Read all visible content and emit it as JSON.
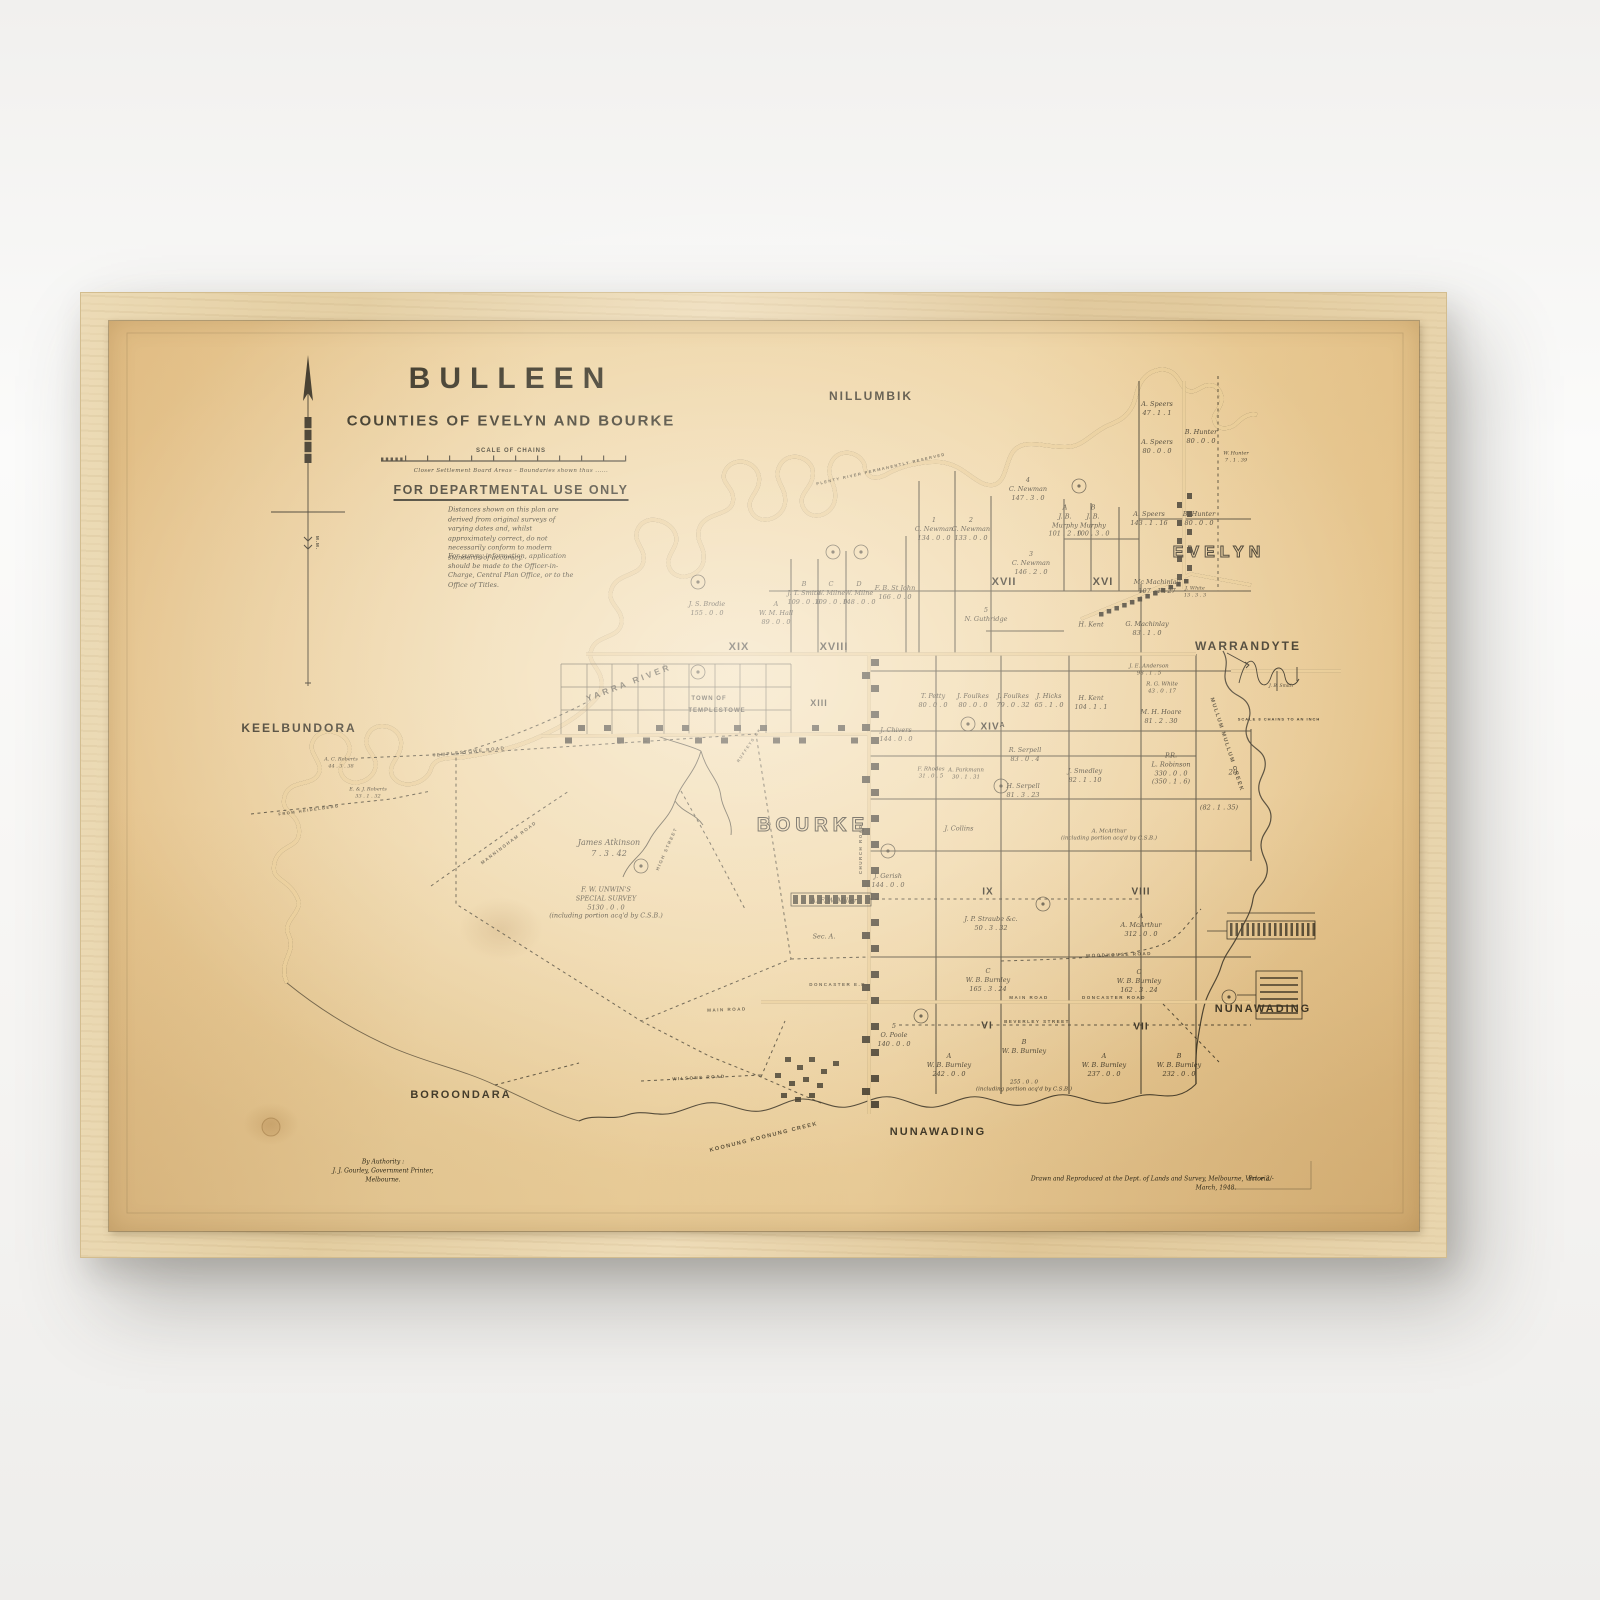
{
  "artwork": {
    "type": "framed vintage cadastral map",
    "frame_wood_color": "#e6d2a8",
    "paper_color": "#e9cb93",
    "ink_color": "#3a3222"
  },
  "map": {
    "header": {
      "title": "BULLEEN",
      "subtitle": "COUNTIES OF EVELYN AND BOURKE",
      "scale_heading": "SCALE OF CHAINS",
      "scale_note": "Closer Settlement Board Areas – Boundaries shown thus ......",
      "departmental": "FOR DEPARTMENTAL USE ONLY",
      "disclaimer_1": "Distances shown on this plan are derived from original surveys of varying dates and, whilst approximately correct, do not necessarily conform to modern standards of accuracy.",
      "disclaimer_2": "For survey information, application should be made to the Officer-in-Charge, Central Plan Office, or to the Office of Titles."
    },
    "north_arrow_label": "M.M.",
    "outline_regions": [
      {
        "t": "BOURKE",
        "x": 704,
        "y": 510,
        "fs": 19,
        "ls": 5
      },
      {
        "t": "EVELYN",
        "x": 1110,
        "y": 236,
        "fs": 16,
        "ls": 5
      }
    ],
    "regions": [
      {
        "t": "NILLUMBIK",
        "x": 762,
        "y": 76,
        "s": 12
      },
      {
        "t": "WARRANDYTE",
        "x": 1139,
        "y": 326,
        "s": 12
      },
      {
        "t": "KEELBUNDORA",
        "x": 190,
        "y": 408,
        "s": 12
      },
      {
        "t": "BOROONDARA",
        "x": 352,
        "y": 774,
        "s": 11
      },
      {
        "t": "NUNAWADING",
        "x": 1154,
        "y": 688,
        "s": 11
      },
      {
        "t": "NUNAWADING",
        "x": 829,
        "y": 811,
        "s": 11
      }
    ],
    "sections": [
      {
        "t": "XIX",
        "x": 630,
        "y": 326,
        "s": 11
      },
      {
        "t": "XVIII",
        "x": 725,
        "y": 326,
        "s": 11
      },
      {
        "t": "XIII",
        "x": 710,
        "y": 383,
        "s": 9
      },
      {
        "t": "XVII",
        "x": 895,
        "y": 261,
        "s": 11
      },
      {
        "t": "XVI",
        "x": 994,
        "y": 261,
        "s": 11
      },
      {
        "t": "XIVᴬ",
        "x": 884,
        "y": 406,
        "s": 10
      },
      {
        "t": "IX",
        "x": 879,
        "y": 571,
        "s": 10
      },
      {
        "t": "VIII",
        "x": 1032,
        "y": 571,
        "s": 10
      },
      {
        "t": "VI",
        "x": 878,
        "y": 705,
        "s": 10
      },
      {
        "t": "VII",
        "x": 1032,
        "y": 706,
        "s": 10
      }
    ],
    "micro_labels": [
      {
        "t": "TOWN OF",
        "x": 600,
        "y": 379,
        "s": 6
      },
      {
        "t": "TEMPLESTOWE",
        "x": 608,
        "y": 391,
        "s": 6
      },
      {
        "t": "SCALE 8 CHAINS TO AN INCH",
        "x": 1170,
        "y": 398,
        "s": 4
      },
      {
        "t": "M.M.",
        "x": 208,
        "y": 222,
        "s": 4.5,
        "r": 90
      }
    ],
    "parcels": [
      {
        "t": "J. S. Brodie\n155 . 0 . 0",
        "x": 598,
        "y": 288
      },
      {
        "t": "A\nW. M. Hall\n89 . 0 . 0",
        "x": 667,
        "y": 292
      },
      {
        "t": "B\nJ. T. Smith\n109 . 0 . 0",
        "x": 695,
        "y": 272
      },
      {
        "t": "C\nW. Milne\n109 . 0 . 0",
        "x": 722,
        "y": 272
      },
      {
        "t": "D\nW. Milne\n148 . 0 . 0",
        "x": 750,
        "y": 272
      },
      {
        "t": "F. B. St John\n166 . 0 . 0",
        "x": 786,
        "y": 272
      },
      {
        "t": "1\nC. Newman\n134 . 0 . 0",
        "x": 825,
        "y": 208
      },
      {
        "t": "2\nC. Newman\n133 . 0 . 0",
        "x": 862,
        "y": 208
      },
      {
        "t": "4\nC. Newman\n147 . 3 . 0",
        "x": 919,
        "y": 168
      },
      {
        "t": "3\nC. Newman\n146 . 2 . 0",
        "x": 922,
        "y": 242
      },
      {
        "t": "A\nJ. B.\nMurphy\n101 . 2 . 0",
        "x": 956,
        "y": 200
      },
      {
        "t": "B\nJ. B.\nMurphy\n100 . 3 . 0",
        "x": 984,
        "y": 200
      },
      {
        "t": "A. Speers\n47 . 1 . 1",
        "x": 1048,
        "y": 88
      },
      {
        "t": "A. Speers\n80 . 0 . 0",
        "x": 1048,
        "y": 126
      },
      {
        "t": "B. Hunter\n80 . 0 . 0",
        "x": 1092,
        "y": 116
      },
      {
        "t": "W. Hunter\n7 . 1 . 39",
        "x": 1127,
        "y": 136,
        "s": 5
      },
      {
        "t": "A. Speers\n143 . 1 . 16",
        "x": 1040,
        "y": 198
      },
      {
        "t": "B. Hunter\n80 . 0 . 0",
        "x": 1090,
        "y": 198
      },
      {
        "t": "Mc Machinlay\n107 . 1 . 27",
        "x": 1048,
        "y": 266
      },
      {
        "t": "J. White\n13 . 3 . 3",
        "x": 1086,
        "y": 271,
        "s": 5
      },
      {
        "t": "G. Machinlay\n83 . 1 . 0",
        "x": 1038,
        "y": 308
      },
      {
        "t": "H. Kent",
        "x": 982,
        "y": 304
      },
      {
        "t": "5\nN. Guthridge",
        "x": 877,
        "y": 294
      },
      {
        "t": "J. E. Anderson\n98 . 1 . 5",
        "x": 1040,
        "y": 350,
        "s": 5.5
      },
      {
        "t": "R. G. White\n43 . 0 . 17",
        "x": 1053,
        "y": 368,
        "s": 5.5
      },
      {
        "t": "M. H. Hoare\n81 . 2 . 30",
        "x": 1052,
        "y": 396
      },
      {
        "t": "H. Kent\n104 . 1 . 1",
        "x": 982,
        "y": 382
      },
      {
        "t": "T. Petty\n80 . 0 . 0",
        "x": 824,
        "y": 380
      },
      {
        "t": "J. Foulkes\n80 . 0 . 0",
        "x": 864,
        "y": 380
      },
      {
        "t": "J. Foulkes\n79 . 0 . 32",
        "x": 904,
        "y": 380
      },
      {
        "t": "J. Hicks\n65 . 1 . 0",
        "x": 940,
        "y": 380
      },
      {
        "t": "J. Chivers\n144 . 0 . 0",
        "x": 787,
        "y": 414
      },
      {
        "t": "R. Serpell\n83 . 0 . 4",
        "x": 916,
        "y": 434
      },
      {
        "t": "F. Rhodes\n31 . 0 . 5",
        "x": 822,
        "y": 453,
        "s": 5.5
      },
      {
        "t": "A. Parkmann\n30 . 1 . 31",
        "x": 857,
        "y": 454,
        "s": 5.5
      },
      {
        "t": "H. Serpell\n81 . 3 . 23",
        "x": 914,
        "y": 470
      },
      {
        "t": "J. Smedley\n82 . 1 . 10",
        "x": 976,
        "y": 455
      },
      {
        "t": "P.R.\nL. Robinson\n330 . 0 . 0\n(350 . 1 . 6)",
        "x": 1062,
        "y": 448
      },
      {
        "t": "20",
        "x": 1124,
        "y": 452,
        "s": 7
      },
      {
        "t": "(82 . 1 . 35)",
        "x": 1110,
        "y": 487
      },
      {
        "t": "J. Collins",
        "x": 850,
        "y": 508
      },
      {
        "t": "J. Gerish\n144 . 0 . 0",
        "x": 779,
        "y": 560
      },
      {
        "t": "A. McArthur\n(including portion acq'd by C.S.B.)",
        "x": 1000,
        "y": 515,
        "s": 5.5
      },
      {
        "t": "A. F. W. Miller",
        "x": 725,
        "y": 580
      },
      {
        "t": "Sec. A.",
        "x": 715,
        "y": 616
      },
      {
        "t": "J. P. Straube &c.\n50 . 3 . 32",
        "x": 882,
        "y": 603
      },
      {
        "t": "A\nA. McArthur\n312 . 0 . 0",
        "x": 1032,
        "y": 604
      },
      {
        "t": "C\nW. B. Burnley\n165 . 3 . 24",
        "x": 879,
        "y": 659
      },
      {
        "t": "C\nW. B. Burnley\n162 . 3 . 24",
        "x": 1030,
        "y": 660
      },
      {
        "t": "5\nO. Poole\n140 . 0 . 0",
        "x": 785,
        "y": 714
      },
      {
        "t": "B\nW. B. Burnley",
        "x": 915,
        "y": 726
      },
      {
        "t": "A\nW. B. Burnley\n242 . 0 . 0",
        "x": 840,
        "y": 744
      },
      {
        "t": "255 . 0 . 0\n(including portion acq'd by C.S.B.)",
        "x": 915,
        "y": 766,
        "s": 5.5
      },
      {
        "t": "A\nW. B. Burnley\n237 . 0 . 0",
        "x": 995,
        "y": 744
      },
      {
        "t": "B\nW. B. Burnley\n232 . 0 . 0",
        "x": 1070,
        "y": 744
      },
      {
        "t": "James Atkinson\n7 . 3 . 42",
        "x": 500,
        "y": 528,
        "s": 8
      },
      {
        "t": "F. W. UNWIN'S\nSPECIAL SURVEY\n5130 . 0 . 0\n(including portion acq'd by C.S.B.)",
        "x": 497,
        "y": 582,
        "s": 6.5
      },
      {
        "t": "A. C. Roberts\n44 . 3 . 38",
        "x": 232,
        "y": 442,
        "s": 5
      },
      {
        "t": "E. & J. Roberts\n33 . 1 . 32",
        "x": 259,
        "y": 472,
        "s": 5
      },
      {
        "t": "J. B. Smith",
        "x": 1172,
        "y": 366,
        "s": 4.5
      }
    ],
    "roads": [
      {
        "t": "YARRA  RIVER",
        "x": 520,
        "y": 362,
        "r": -21,
        "s": 8.5,
        "ls": 3
      },
      {
        "t": "TEMPLESTOWE  ROAD",
        "x": 360,
        "y": 431,
        "r": -6,
        "s": 4.5
      },
      {
        "t": "MANNINGHAM  ROAD",
        "x": 400,
        "y": 522,
        "r": -37,
        "s": 4.5
      },
      {
        "t": "FROM  HEIDELBERG",
        "x": 200,
        "y": 489,
        "r": -8,
        "s": 4
      },
      {
        "t": "HIGH  STREET",
        "x": 558,
        "y": 528,
        "r": -66,
        "s": 4.5
      },
      {
        "t": "CHURCH  ROAD",
        "x": 752,
        "y": 528,
        "r": -90,
        "s": 4.5
      },
      {
        "t": "RUFFEYS  CK",
        "x": 640,
        "y": 424,
        "r": -56,
        "s": 4
      },
      {
        "t": "DONCASTER  E.R.",
        "x": 730,
        "y": 664,
        "r": 0,
        "s": 4.5
      },
      {
        "t": "MAIN  ROAD",
        "x": 618,
        "y": 689,
        "r": -2,
        "s": 4.5
      },
      {
        "t": "MAIN  ROAD",
        "x": 920,
        "y": 677,
        "r": 0,
        "s": 4.5
      },
      {
        "t": "DONCASTER  ROAD",
        "x": 1005,
        "y": 677,
        "r": 0,
        "s": 4.5
      },
      {
        "t": "WOODHOUSE  ROAD",
        "x": 1010,
        "y": 634,
        "r": -2,
        "s": 4.5
      },
      {
        "t": "BEVERLEY  STREET",
        "x": 928,
        "y": 701,
        "r": 0,
        "s": 4.5
      },
      {
        "t": "WILSONS  ROAD",
        "x": 590,
        "y": 757,
        "r": -3,
        "s": 4.5
      },
      {
        "t": "KOONUNG  KOONUNG  CREEK",
        "x": 655,
        "y": 817,
        "r": -14,
        "s": 5.5
      },
      {
        "t": "MULLUM  MULLUM  CREEK",
        "x": 1117,
        "y": 424,
        "r": 72,
        "s": 5.5
      },
      {
        "t": "PLENTY  RIVER  PERMANENTLY  RESERVED",
        "x": 772,
        "y": 148,
        "r": -13,
        "s": 4
      }
    ],
    "credits": {
      "authority": "By Authority :\nJ. J. Gourley, Government Printer,\nMelbourne.",
      "drawn": "Drawn and Reproduced at the Dept. of Lands and Survey, Melbourne, Victoria.",
      "date": "March, 1948.",
      "price": "Price 2/-"
    }
  }
}
